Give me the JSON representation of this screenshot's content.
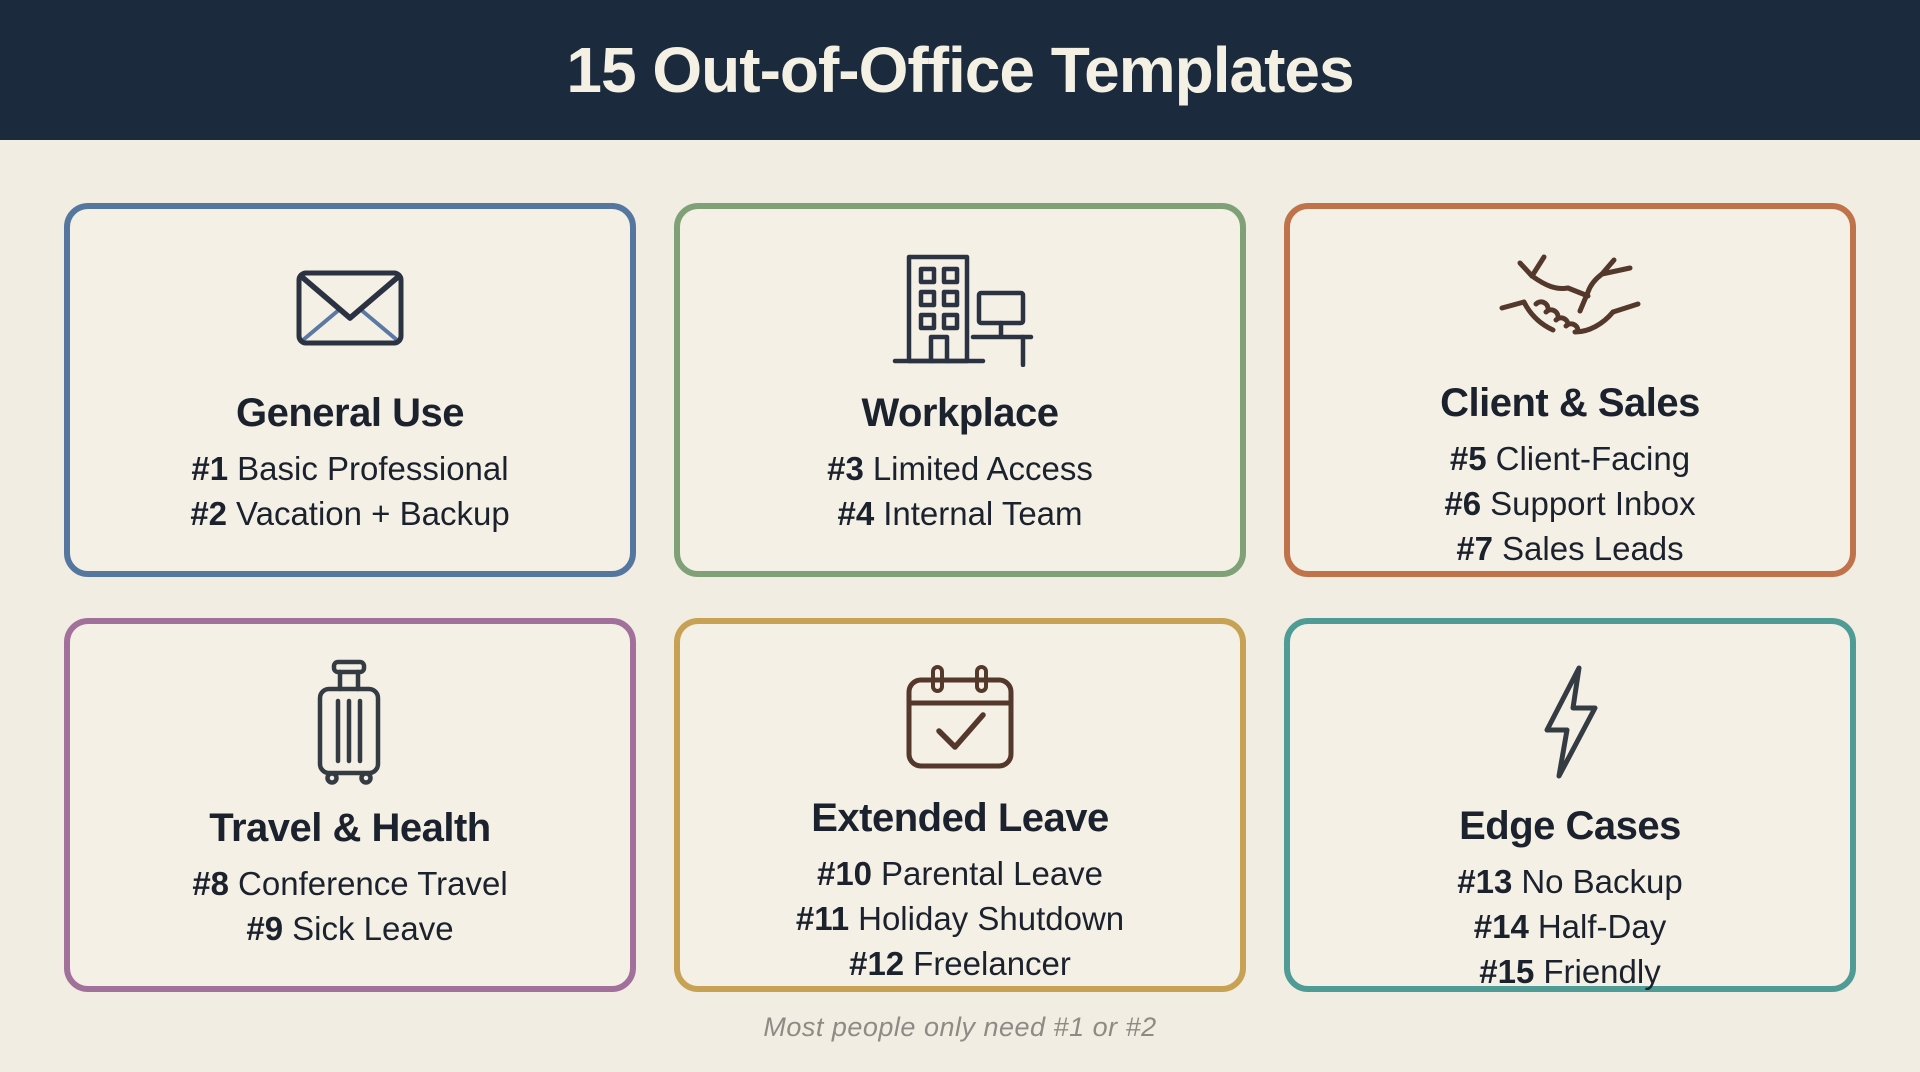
{
  "header": {
    "title": "15 Out-of-Office Templates"
  },
  "footer": {
    "note": "Most people only need #1 or #2"
  },
  "colors": {
    "page_bg": "#f1ede2",
    "header_bg": "#1b2a3d",
    "header_text": "#f4f0e4",
    "card_bg": "#f4f0e6",
    "text_ink": "#1c222d",
    "icon_ink": "#2b3342",
    "icon_brown": "#54382b",
    "icon_dark": "#343b42",
    "envelope_diagonal": "#5b79a3",
    "footer_text": "#8c8b84"
  },
  "cards": [
    {
      "id": "general-use",
      "title": "General Use",
      "icon": "envelope-icon",
      "accent": "#55779f",
      "items": [
        {
          "num": "#1",
          "label": "Basic Professional"
        },
        {
          "num": "#2",
          "label": "Vacation + Backup"
        }
      ]
    },
    {
      "id": "workplace",
      "title": "Workplace",
      "icon": "office-building-icon",
      "accent": "#80a178",
      "items": [
        {
          "num": "#3",
          "label": "Limited Access"
        },
        {
          "num": "#4",
          "label": "Internal Team"
        }
      ]
    },
    {
      "id": "client-sales",
      "title": "Client & Sales",
      "icon": "handshake-icon",
      "accent": "#c0734b",
      "items": [
        {
          "num": "#5",
          "label": "Client-Facing"
        },
        {
          "num": "#6",
          "label": "Support Inbox"
        },
        {
          "num": "#7",
          "label": "Sales Leads"
        }
      ]
    },
    {
      "id": "travel-health",
      "title": "Travel & Health",
      "icon": "suitcase-icon",
      "accent": "#a1719c",
      "items": [
        {
          "num": "#8",
          "label": "Conference Travel"
        },
        {
          "num": "#9",
          "label": "Sick Leave"
        }
      ]
    },
    {
      "id": "extended-leave",
      "title": "Extended Leave",
      "icon": "calendar-check-icon",
      "accent": "#c8a254",
      "items": [
        {
          "num": "#10",
          "label": "Parental Leave"
        },
        {
          "num": "#11",
          "label": "Holiday Shutdown"
        },
        {
          "num": "#12",
          "label": "Freelancer"
        }
      ]
    },
    {
      "id": "edge-cases",
      "title": "Edge Cases",
      "icon": "lightning-bolt-icon",
      "accent": "#4e9c95",
      "items": [
        {
          "num": "#13",
          "label": "No Backup"
        },
        {
          "num": "#14",
          "label": "Half-Day"
        },
        {
          "num": "#15",
          "label": "Friendly"
        }
      ]
    }
  ]
}
